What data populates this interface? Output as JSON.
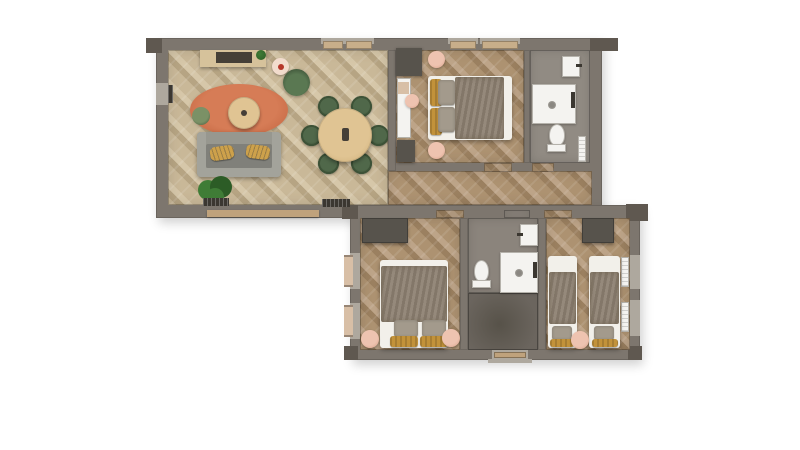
{
  "scene": {
    "type": "apartment-floor-plan-top-down-3d-render",
    "sections": [
      {
        "name": "upper-wing",
        "rooms": [
          {
            "name": "living-dining-room",
            "furniture": [
              "kitchen-sideboard",
              "tv-console-inset",
              "counter-plant",
              "side-table",
              "red-vase",
              "lounge-chair",
              "area-rug",
              "coffee-table",
              "floor-pouf",
              "sofa",
              "sofa-cushion-left",
              "sofa-cushion-right",
              "potted-plant",
              "wall-radiator-left",
              "wall-radiator-a",
              "wall-radiator-b",
              "window-bench",
              "dining-table",
              "dining-centerpiece"
            ],
            "dining_chair_count": 6,
            "window_count": 3
          },
          {
            "name": "bedroom-1",
            "furniture": [
              "double-bed",
              "yellow-bolster-pillows",
              "grey-pillows",
              "duvet",
              "nightstand-top",
              "nightstand-bottom",
              "corner-cabinet",
              "desk",
              "desk-stool",
              "storage-unit"
            ],
            "window_count": 2
          },
          {
            "name": "bathroom-1",
            "furniture": [
              "sink",
              "shower-tray",
              "shower-drain",
              "toilet",
              "towel-radiator"
            ]
          },
          {
            "name": "hallway",
            "furniture": []
          }
        ]
      },
      {
        "name": "lower-wing",
        "rooms": [
          {
            "name": "bedroom-2",
            "furniture": [
              "wardrobe",
              "double-bed",
              "duvet",
              "grey-pillows",
              "yellow-bolster-pillows",
              "nightstand-left",
              "nightstand-right",
              "window-radiator-a",
              "window-radiator-b"
            ],
            "window_count": 2
          },
          {
            "name": "bathroom-2",
            "furniture": [
              "toilet",
              "shower-tray",
              "shower-drain",
              "sink"
            ]
          },
          {
            "name": "entry-hall",
            "furniture": [
              "entry-door"
            ]
          },
          {
            "name": "bedroom-3-twin",
            "furniture": [
              "wardrobe",
              "single-bed-left",
              "single-bed-right",
              "duvets",
              "grey-pillows",
              "yellow-bolster-pillows",
              "shared-nightstand",
              "window-radiator-a",
              "window-radiator-b"
            ],
            "window_count": 2
          }
        ]
      }
    ]
  },
  "palette": {
    "background": "#ffffff",
    "wall": "#7d766e",
    "wall-dark": "#5f5850",
    "wall-light": "#aea89e",
    "floor-living-a": "#c9b898",
    "floor-living-b": "#b6a483",
    "floor-living-c": "#d6c7a9",
    "floor-bed-a": "#ad9271",
    "floor-bed-b": "#9b8060",
    "floor-bed-c": "#bda488",
    "tile-bath1": "#918b83",
    "tile-bath2": "#8b847c",
    "tile-entry": "#6b655e",
    "tile-entry-dark": "#575249",
    "rug": "#d67c56",
    "rug-edge": "#c2643f",
    "wood-table": "#e0c493",
    "wood-counter": "#d6c29b",
    "wood-sill": "#c8ae8a",
    "wood-door": "#bfa27c",
    "sofa": "#97978f",
    "sofa-seat": "#80807a",
    "sofa-arm": "#a3a39b",
    "pillow-yellow": "#cda14b",
    "bolster-yellow": "#c2923a",
    "pillow-grey": "#a39a8c",
    "chair-green": "#50684a",
    "chair-green-dark": "#3d5237",
    "pouf-green": "#7b9166",
    "armchair-green": "#5a7852",
    "pink": "#eec3b0",
    "pink-rim": "#d69c85",
    "pink-light": "#f2dccd",
    "red-accent": "#b5372a",
    "plant": "#3f7c36",
    "plant-dark": "#2c5c26",
    "duvet": "#8d8071",
    "duvet-dark": "#746856",
    "sheet": "#f2f0ea",
    "fixture": "#f4f3f0",
    "fixture-border": "#b5b2ab",
    "wardrobe": "#57534c",
    "inset-dark": "#453f37",
    "radiator-dark": "#3b3731",
    "radiator-tan": "#d8bfa6",
    "shadow": "rgba(0,0,0,0.18)"
  }
}
